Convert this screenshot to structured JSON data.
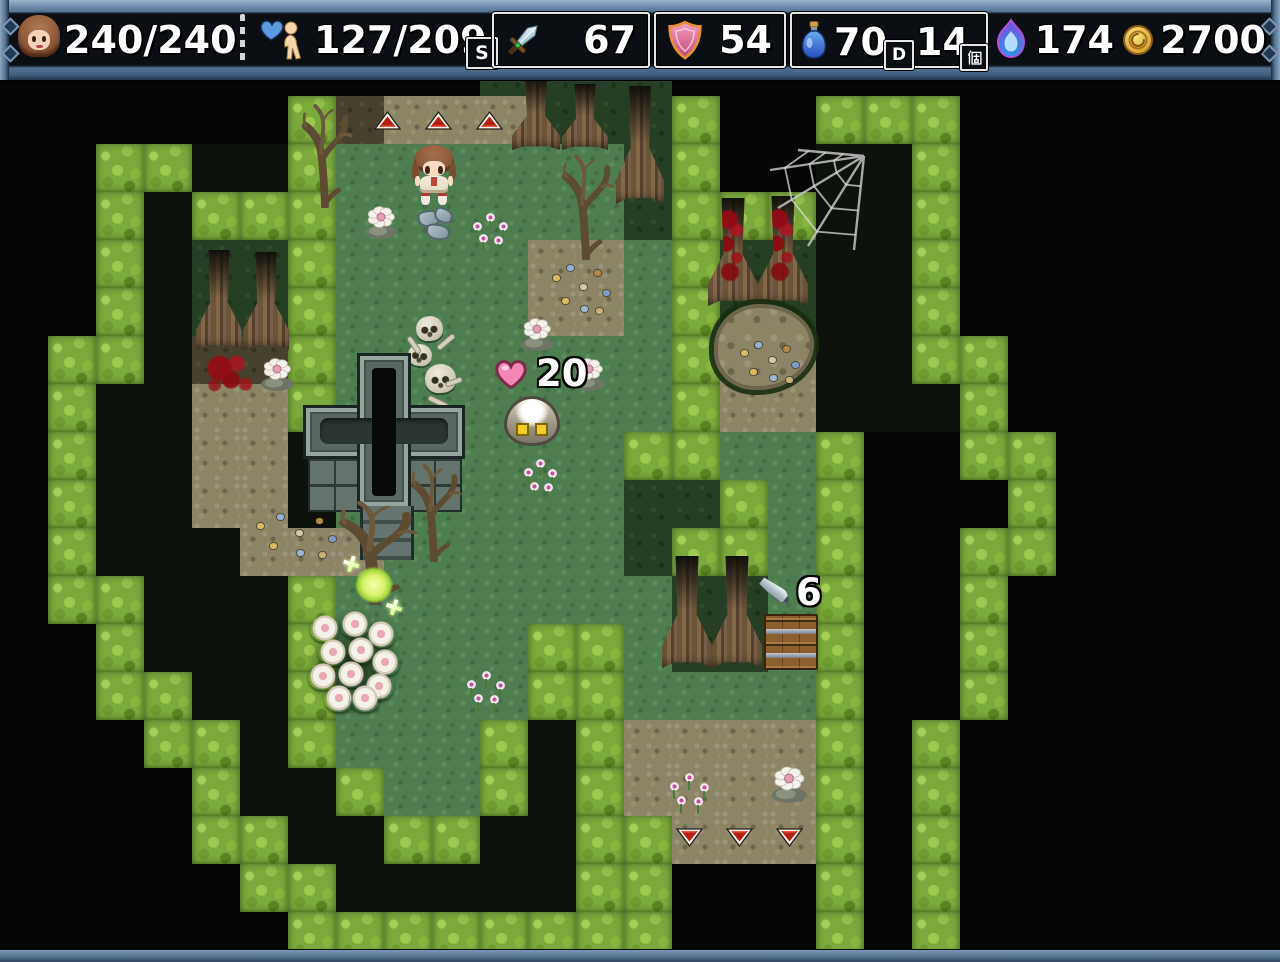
{
  "window": {
    "width": 1280,
    "height": 962
  },
  "hud": {
    "player": {
      "icon": "player-face-icon",
      "hp": "240/240"
    },
    "mp": {
      "icon": "heart-person-icon",
      "value": "127/209",
      "badge": "S"
    },
    "attack": {
      "icon": "sword-icon",
      "value": "67"
    },
    "defense": {
      "icon": "shield-icon",
      "value": "54"
    },
    "items": {
      "icon": "potion-icon",
      "value": "70",
      "slot": "D",
      "count": "14",
      "unit": "個"
    },
    "skill": {
      "icon": "flame-icon",
      "value": "174"
    },
    "gold": {
      "icon": "coin-icon",
      "value": "2700"
    }
  },
  "map": {
    "tile_size": 48,
    "legend": {
      "K": "void",
      "D": "dark-ground",
      "B": "bush",
      "G": "grass",
      "g": "grass-shaded",
      "T": "dirt",
      "t": "dirt-shaded"
    },
    "palette": {
      "void": "#040603",
      "dark": "#0d130c",
      "bush": "#7ca93c",
      "bush_light": "#a6cf58",
      "bush_dark": "#5d8424",
      "grass": "#4e7d52",
      "darkgrass": "#263e24",
      "dirt": "#8c8466",
      "darkdirt": "#46412e",
      "hud_frame": "#5f7d9d",
      "hud_panel": "#0b0e13",
      "accent_red": "#b61e12",
      "heal_pink": "#f585b5",
      "glow_green": "#d7f169"
    },
    "rows": [
      "KKKKKKKKKKKKKKKKKKKKKKKKKKK",
      "KKKKKKKKKKggggKKKKKKKKKKKKK",
      "KKKKKKBtTTTgggBKKBBBKKKKKKK",
      "KKBBDDBGGGGGGgBKKDDBKKKKKKK",
      "KKBDBBBGGGGGGgBBBDDBKKKKKKK",
      "KKBDggBGGGGTTGBggDDBKKKKKKK",
      "KKBDggBGGGGTTGBggDDBKKKKKKK",
      "KBBDttBGGGGGGGBTTDDBBKKKKKK",
      "KBDDTTBGGGGGGGBTTDDDBKKKKKK",
      "KBDDTTDGGGGGGBBGGBKKBBKKKKK",
      "KBDDTTDGGGGGGggBGBKKKBKKKKK",
      "KBDDDTTTGGGGGgBBGBKKBBKKKKK",
      "KBBDDDBGGGGGGGggGBKKBKKKKKK",
      "KKBDDDBGGGGBBGggGBKKBKKKKKK",
      "KKBBDDBGGGGBBGGGGBKKBKKKKKK",
      "KKKBBDBGGGBDBTTTTBKBKKKKKKK",
      "KKKKBDDBGGBDBTTTTBKBKKKKKKK",
      "KKKKBBDDBBDDBBTTTBKBKKKKKKK",
      "KKKKKBBDDDDDBBKKKBKBKKKKKKK",
      "KKKKKKBBBBBBBBKKKBKBKKKKKKK",
      "KKKKKKKKKKKKKKKKKKKKKKKKKKK"
    ],
    "popups": {
      "heal": "20",
      "damage": "6"
    },
    "sprites": [
      {
        "name": "exit-arrow-up",
        "type": "tri-up",
        "x": 374,
        "y": 111,
        "w": 27,
        "h": 19
      },
      {
        "name": "exit-arrow-up",
        "type": "tri-up",
        "x": 425,
        "y": 111,
        "w": 27,
        "h": 19
      },
      {
        "name": "exit-arrow-up",
        "type": "tri-up",
        "x": 476,
        "y": 111,
        "w": 27,
        "h": 19
      },
      {
        "name": "tree",
        "type": "tree",
        "x": 512,
        "y": 78,
        "w": 48,
        "h": 72
      },
      {
        "name": "tree",
        "type": "tree",
        "x": 562,
        "y": 84,
        "w": 46,
        "h": 66
      },
      {
        "name": "tree",
        "type": "tree",
        "x": 616,
        "y": 86,
        "w": 48,
        "h": 118
      },
      {
        "name": "dead-tree",
        "type": "deadtree",
        "x": 296,
        "y": 98,
        "w": 58,
        "h": 110
      },
      {
        "name": "dead-tree",
        "type": "deadtree",
        "x": 556,
        "y": 148,
        "w": 60,
        "h": 112
      },
      {
        "name": "player-character",
        "type": "player",
        "x": 412,
        "y": 145,
        "w": 44,
        "h": 58
      },
      {
        "name": "flower-on-stone",
        "type": "stoneflower",
        "x": 362,
        "y": 204,
        "w": 38,
        "h": 36
      },
      {
        "name": "stones",
        "type": "stones",
        "x": 418,
        "y": 208,
        "w": 44,
        "h": 32
      },
      {
        "name": "pink-flowers",
        "type": "pinkflowers",
        "x": 468,
        "y": 210,
        "w": 44,
        "h": 40
      },
      {
        "name": "scattered-items",
        "type": "scatter",
        "x": 548,
        "y": 258,
        "w": 64,
        "h": 62
      },
      {
        "name": "tree",
        "type": "tree",
        "x": 196,
        "y": 250,
        "w": 46,
        "h": 100
      },
      {
        "name": "tree",
        "type": "tree",
        "x": 243,
        "y": 252,
        "w": 46,
        "h": 98
      },
      {
        "name": "blood-splatter",
        "type": "blood",
        "x": 202,
        "y": 352,
        "w": 58,
        "h": 46
      },
      {
        "name": "flower-on-stone",
        "type": "stoneflower",
        "x": 258,
        "y": 356,
        "w": 38,
        "h": 36
      },
      {
        "name": "tree-bloodied",
        "type": "tree",
        "blood": true,
        "x": 708,
        "y": 198,
        "w": 50,
        "h": 108
      },
      {
        "name": "tree-bloodied",
        "type": "tree",
        "blood": true,
        "x": 758,
        "y": 196,
        "w": 50,
        "h": 110
      },
      {
        "name": "spider-web",
        "type": "web",
        "x": 768,
        "y": 146,
        "w": 104,
        "h": 106
      },
      {
        "name": "dirt-pond",
        "type": "pond",
        "x": 714,
        "y": 304,
        "w": 100,
        "h": 86
      },
      {
        "name": "scattered-items",
        "type": "scatter",
        "x": 736,
        "y": 336,
        "w": 66,
        "h": 50
      },
      {
        "name": "skull-pile",
        "type": "skulls",
        "x": 408,
        "y": 312,
        "w": 60,
        "h": 96
      },
      {
        "name": "heal-popup",
        "type": "heal",
        "x": 492,
        "y": 355,
        "w": 84,
        "h": 42,
        "bind": "map.popups.heal"
      },
      {
        "name": "flower-on-stone",
        "type": "stoneflower",
        "x": 518,
        "y": 316,
        "w": 38,
        "h": 36
      },
      {
        "name": "flower-on-stone",
        "type": "stoneflower",
        "x": 570,
        "y": 356,
        "w": 38,
        "h": 36
      },
      {
        "name": "stone-creature",
        "type": "creature",
        "x": 504,
        "y": 396,
        "w": 56,
        "h": 50
      },
      {
        "name": "crypt",
        "type": "crypt",
        "x": 306,
        "y": 356,
        "w": 156,
        "h": 206
      },
      {
        "name": "pink-flowers",
        "type": "pinkflowers",
        "x": 520,
        "y": 456,
        "w": 40,
        "h": 42
      },
      {
        "name": "dead-tree",
        "type": "deadtree",
        "x": 330,
        "y": 495,
        "w": 90,
        "h": 110
      },
      {
        "name": "dead-tree",
        "type": "deadtree",
        "x": 405,
        "y": 458,
        "w": 58,
        "h": 104
      },
      {
        "name": "scattered-items",
        "type": "scatter",
        "x": 250,
        "y": 508,
        "w": 92,
        "h": 54
      },
      {
        "name": "glowing-item",
        "type": "glow",
        "x": 348,
        "y": 560,
        "w": 52,
        "h": 50
      },
      {
        "name": "flower-bush",
        "type": "flowerbush",
        "x": 306,
        "y": 610,
        "w": 96,
        "h": 108
      },
      {
        "name": "tree",
        "type": "tree",
        "x": 662,
        "y": 556,
        "w": 50,
        "h": 112
      },
      {
        "name": "tree",
        "type": "tree",
        "x": 712,
        "y": 556,
        "w": 50,
        "h": 112
      },
      {
        "name": "damage-popup",
        "type": "damage",
        "x": 758,
        "y": 574,
        "w": 64,
        "h": 46,
        "bind": "map.popups.damage"
      },
      {
        "name": "wooden-crates",
        "type": "crates",
        "x": 764,
        "y": 614,
        "w": 54,
        "h": 56
      },
      {
        "name": "pink-flowers",
        "type": "pinkflowers",
        "x": 462,
        "y": 668,
        "w": 48,
        "h": 42
      },
      {
        "name": "pink-flowers",
        "type": "pinkflowers",
        "x": 664,
        "y": 770,
        "w": 50,
        "h": 42
      },
      {
        "name": "flower-on-stone",
        "type": "stoneflower",
        "x": 768,
        "y": 764,
        "w": 42,
        "h": 40
      },
      {
        "name": "exit-arrow-down",
        "type": "tri-down",
        "x": 676,
        "y": 828,
        "w": 27,
        "h": 19
      },
      {
        "name": "exit-arrow-down",
        "type": "tri-down",
        "x": 726,
        "y": 828,
        "w": 27,
        "h": 19
      },
      {
        "name": "exit-arrow-down",
        "type": "tri-down",
        "x": 776,
        "y": 828,
        "w": 27,
        "h": 19
      }
    ]
  }
}
